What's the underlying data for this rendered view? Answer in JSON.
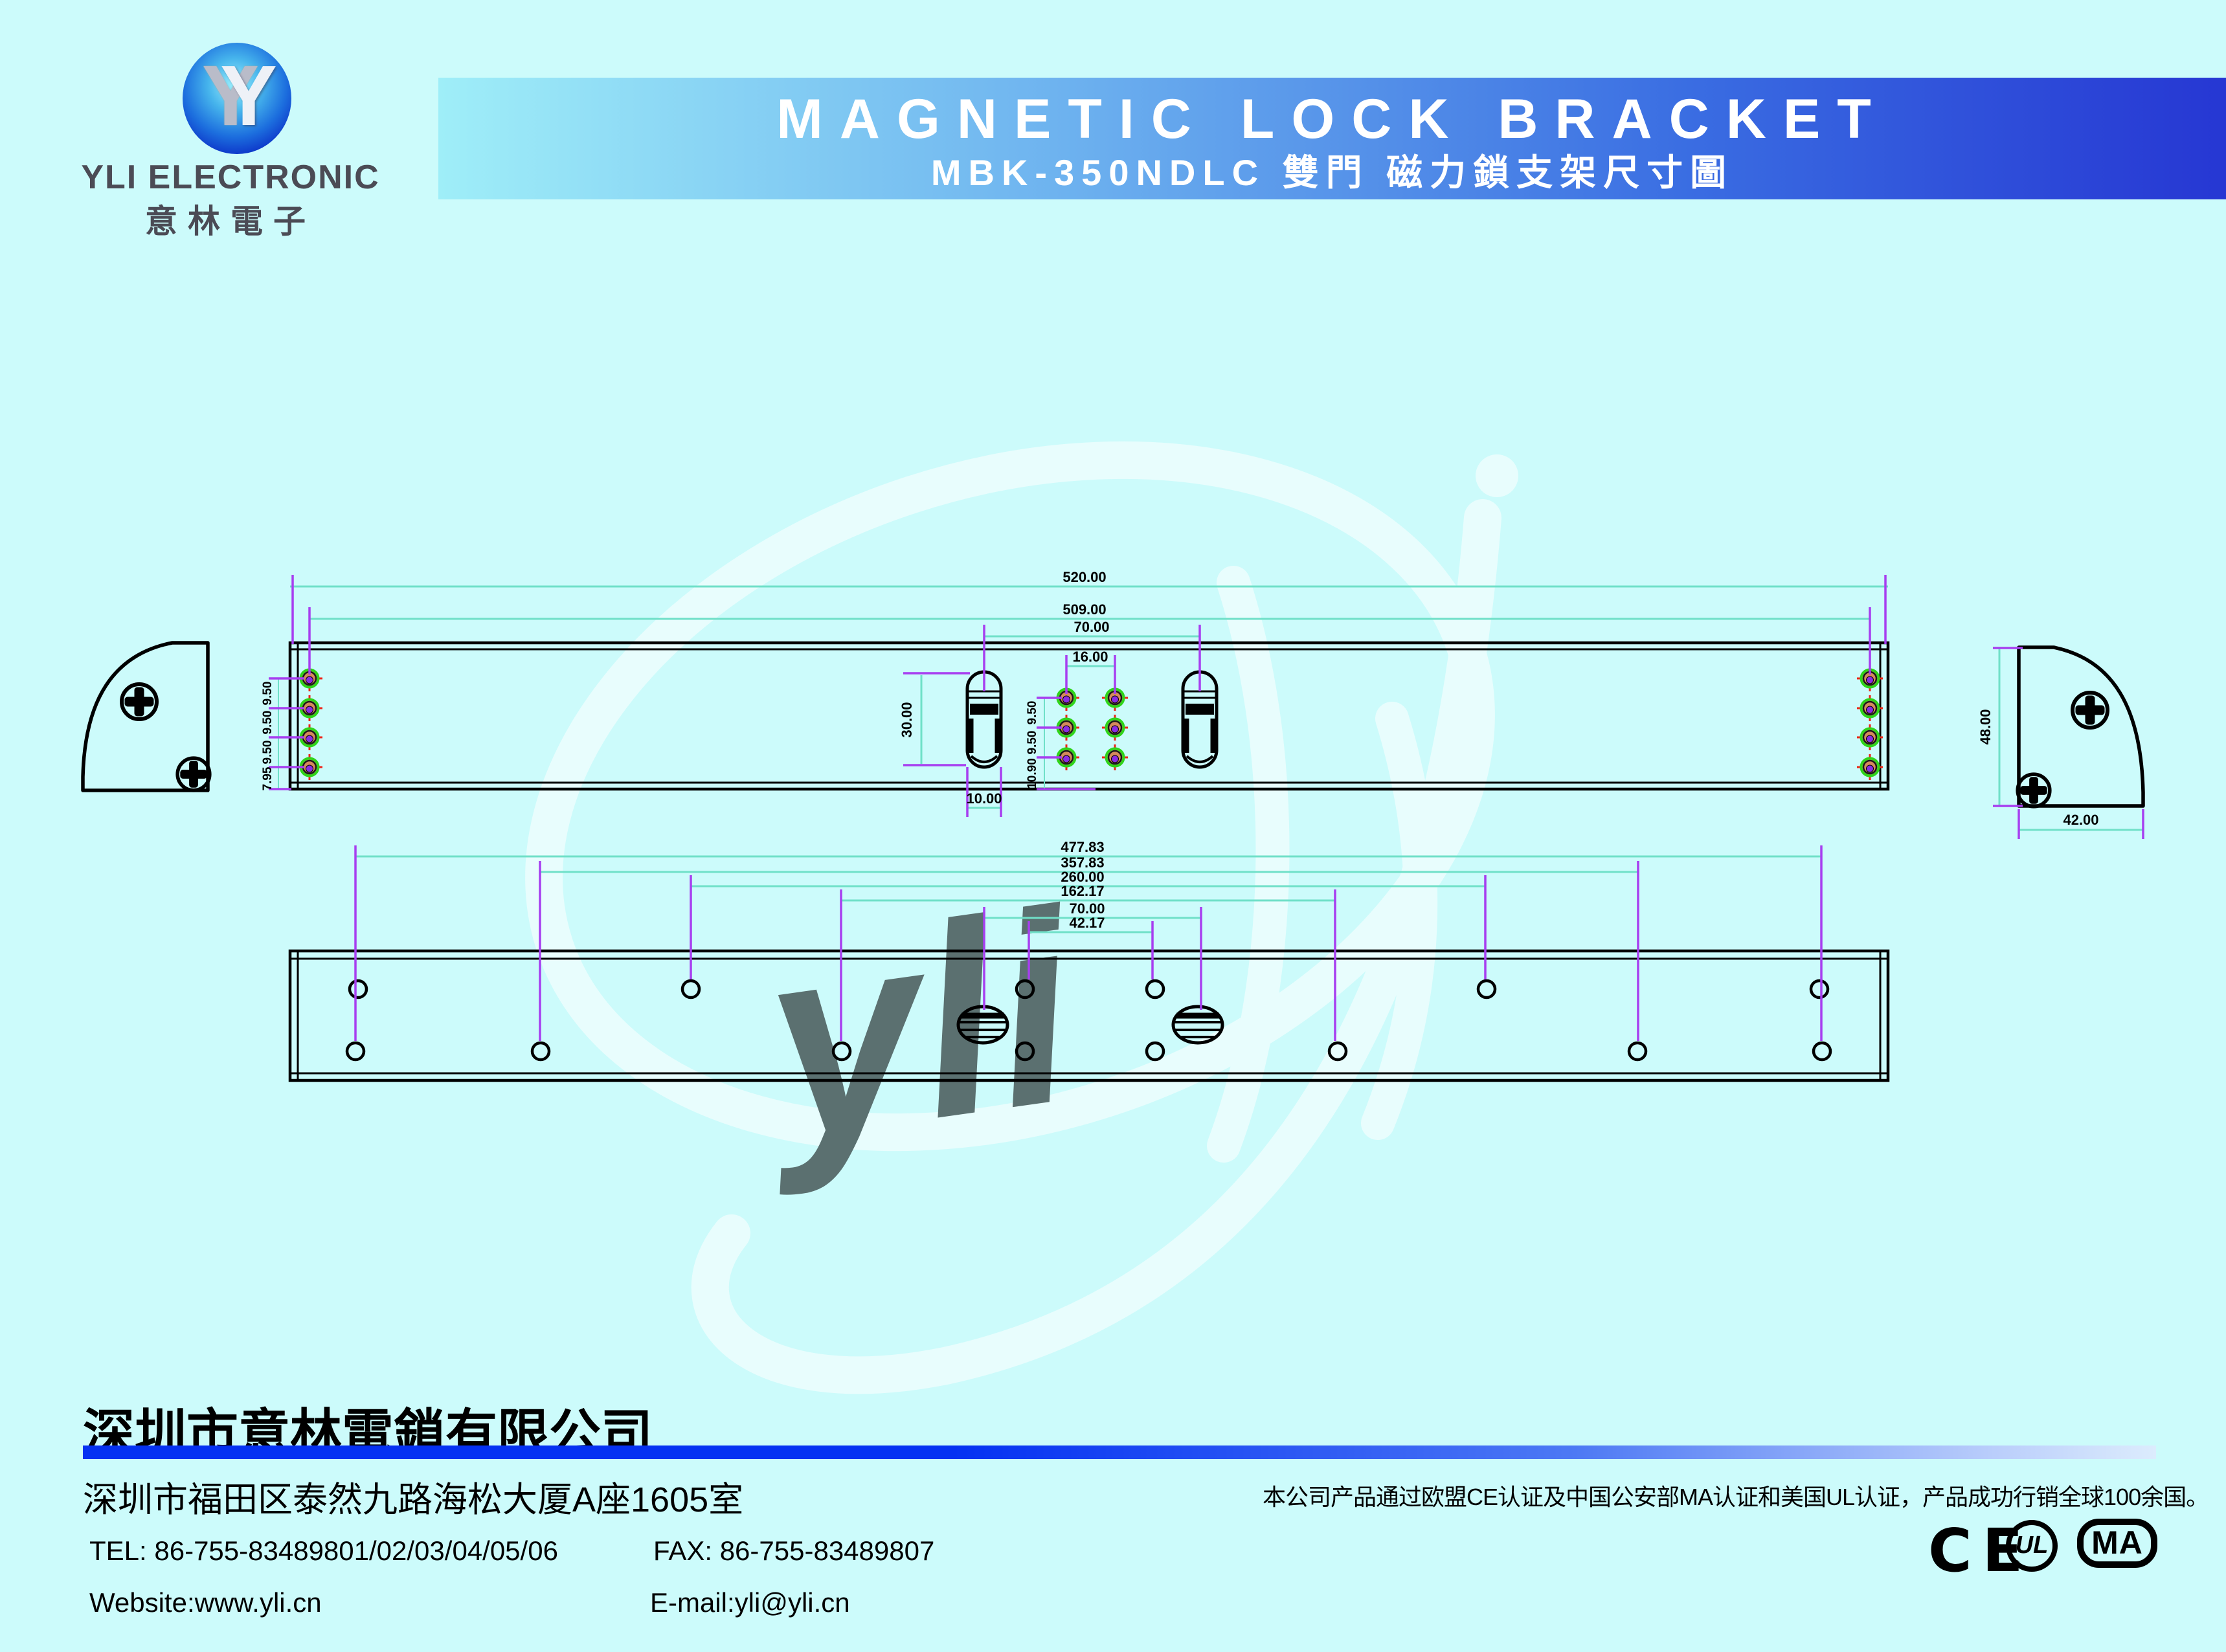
{
  "header": {
    "logo_text": "YLI ELECTRONIC",
    "logo_cn": "意林電子",
    "logo_monogram": "Y",
    "banner_title": "MAGNETIC LOCK BRACKET",
    "banner_subtitle": "MBK-350NDLC 雙門 磁力鎖支架尺寸圖"
  },
  "watermark": {
    "text": "yli"
  },
  "front_view": {
    "dim_length": "520.00",
    "dim_hole_span": "509.00",
    "dim_slot_span": "70.00",
    "dim_hole_pair": "16.00",
    "dim_slot_height": "30.00",
    "dim_slot_width": "10.00",
    "left_spacing_1": "9.50",
    "left_spacing_2": "9.50",
    "left_spacing_3": "9.50",
    "left_spacing_4": "7.95",
    "mid_spacing_1": "9.50",
    "mid_spacing_2": "9.50",
    "mid_spacing_3": "10.90"
  },
  "side_view": {
    "dim_height": "48.00",
    "dim_depth": "42.00"
  },
  "bottom_view": {
    "dim_1": "477.83",
    "dim_2": "357.83",
    "dim_3": "260.00",
    "dim_4": "162.17",
    "dim_5": "70.00",
    "dim_6": "42.17"
  },
  "footer": {
    "company_cn": "深圳市意林電鎖有限公司",
    "address_cn": "深圳市福田区泰然九路海松大厦A座1605室",
    "cert_note_cn": "本公司产品通过欧盟CE认证及中国公安部MA认证和美国UL认证，产品成功行销全球100余国。",
    "tel": "TEL: 86-755-83489801/02/03/04/05/06",
    "fax": "FAX: 86-755-83489807",
    "website": "Website:www.yli.cn",
    "email": "E-mail:yli@yli.cn",
    "cert_ce": "CE",
    "cert_ul": "UL",
    "cert_ul_r": "®",
    "cert_ma": "MA"
  },
  "colors": {
    "background": "#ccfbfb",
    "dim_line": "#70e0c8",
    "extension_line": "#a73ef0",
    "banner_blue": "#2637d3",
    "bar_blue": "#0531f2"
  }
}
